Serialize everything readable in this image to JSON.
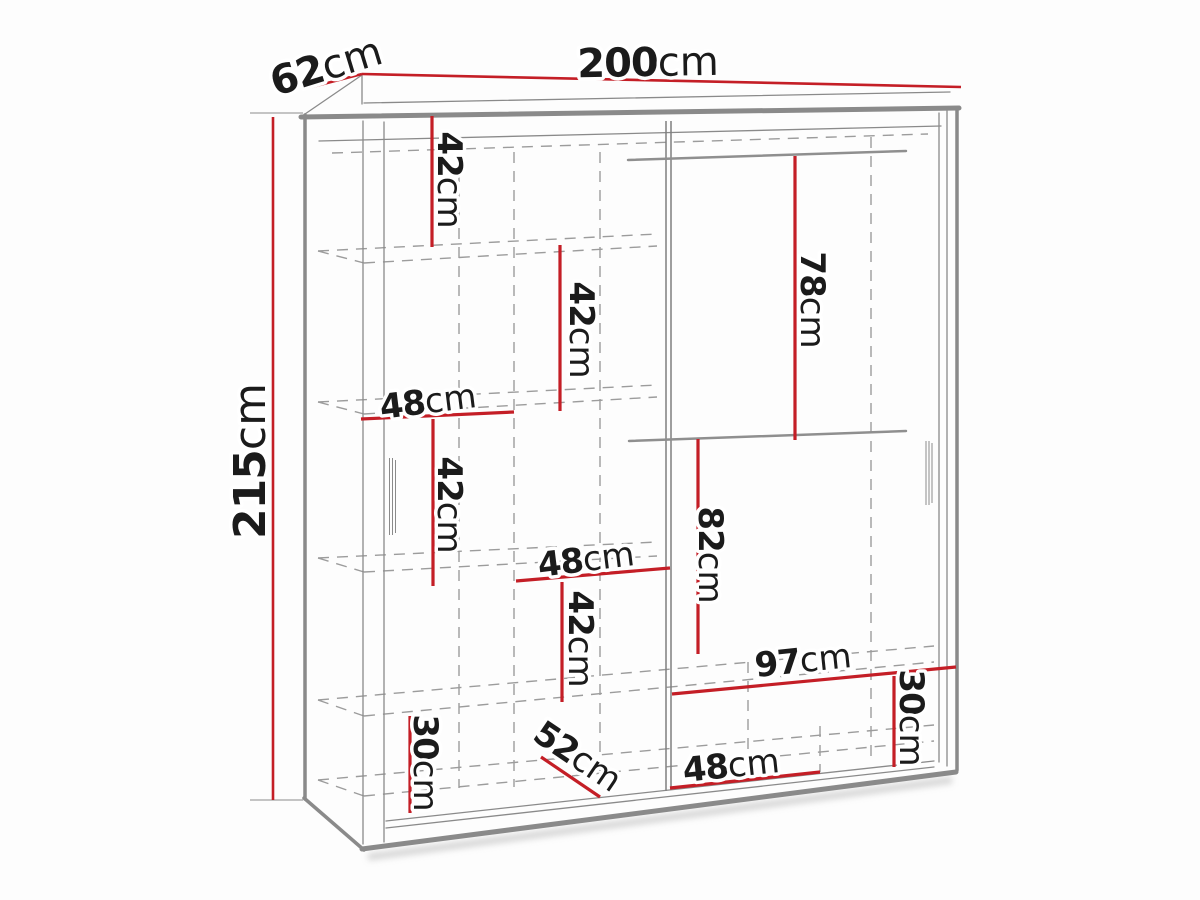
{
  "diagram": {
    "type": "wardrobe-dimension-diagram",
    "overall": {
      "width": "200cm",
      "depth": "62cm",
      "height": "215cm"
    },
    "colors": {
      "dimension_red": "#c41e26",
      "line_gray": "#8a8a8a",
      "dash_gray": "#9c9c9c",
      "text": "#1b1b1b",
      "background": "#fdfdfd"
    },
    "dims": {
      "d200": {
        "value": "200",
        "unit": "cm"
      },
      "d62": {
        "value": "62",
        "unit": "cm"
      },
      "d215": {
        "value": "215",
        "unit": "cm"
      },
      "i42a": {
        "value": "42",
        "unit": "cm"
      },
      "i42b": {
        "value": "42",
        "unit": "cm"
      },
      "i48a": {
        "value": "48",
        "unit": "cm"
      },
      "i42c": {
        "value": "42",
        "unit": "cm"
      },
      "i78": {
        "value": "78",
        "unit": "cm"
      },
      "i48b": {
        "value": "48",
        "unit": "cm"
      },
      "i42d": {
        "value": "42",
        "unit": "cm"
      },
      "i82": {
        "value": "82",
        "unit": "cm"
      },
      "i97": {
        "value": "97",
        "unit": "cm"
      },
      "i30a": {
        "value": "30",
        "unit": "cm"
      },
      "i48c": {
        "value": "48",
        "unit": "cm"
      },
      "i52": {
        "value": "52",
        "unit": "cm"
      },
      "i30b": {
        "value": "30",
        "unit": "cm"
      }
    }
  }
}
